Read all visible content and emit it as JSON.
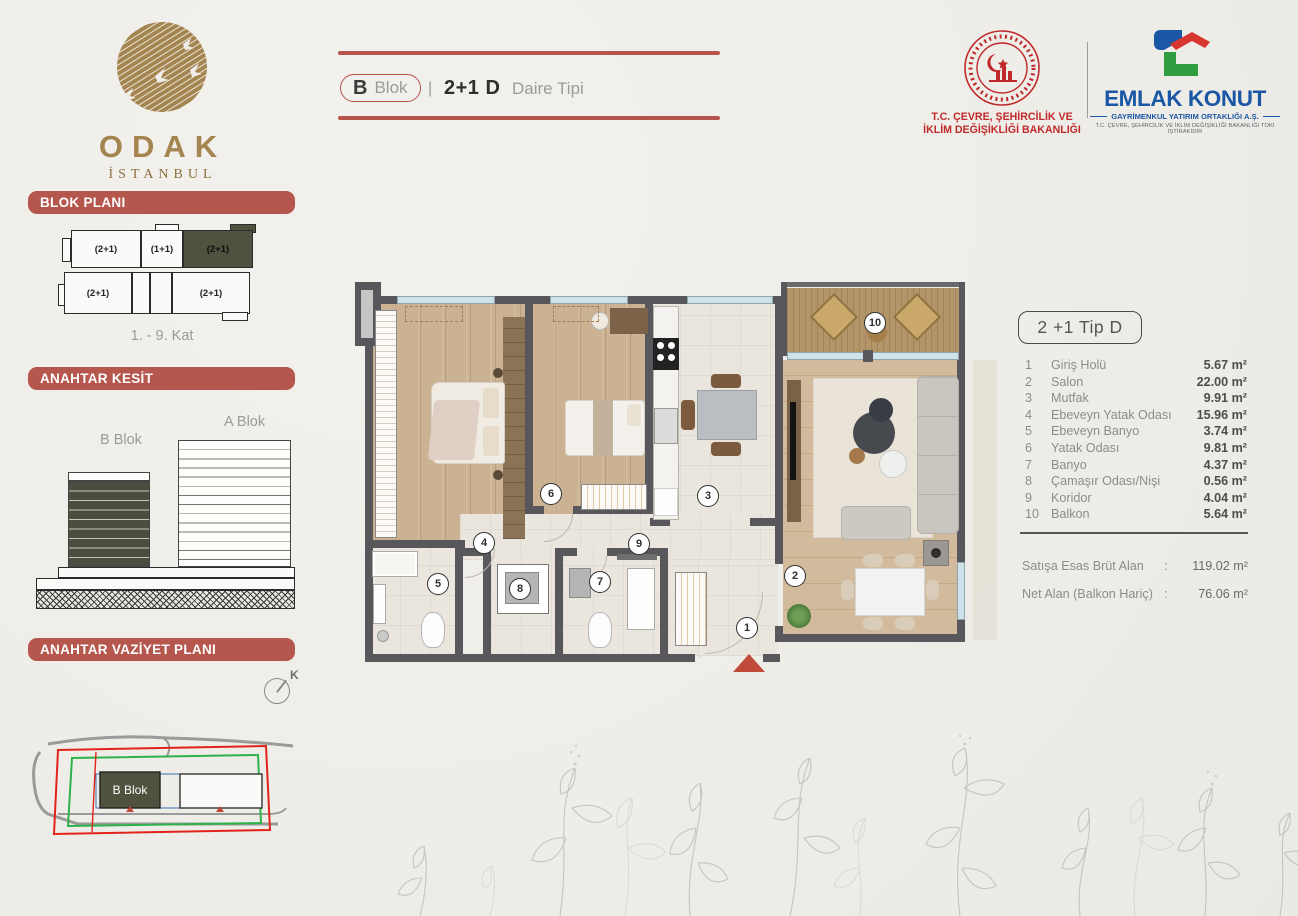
{
  "header": {
    "block_letter": "B",
    "block_word": "Blok",
    "separator": "|",
    "unit_type": "2+1 D",
    "subtitle": "Daire Tipi"
  },
  "brand": {
    "name": "ODAK",
    "city": "İSTANBUL"
  },
  "ministry": {
    "line1": "T.C. ÇEVRE, ŞEHİRCİLİK VE",
    "line2": "İKLİM DEĞİŞİKLİĞİ BAKANLIĞI"
  },
  "emlak": {
    "name": "EMLAK KONUT",
    "subtitle": "GAYRİMENKUL YATIRIM ORTAKLIĞI A.Ş.",
    "tagline": "T.C. ÇEVRE, ŞEHİRCİLİK VE İKLİM DEĞİŞİKLİĞİ BAKANLIĞI TOKİ İŞTİRAKİDİR"
  },
  "sidebar": {
    "section1_title": "BLOK PLANI",
    "section2_title": "ANAHTAR KESİT",
    "section3_title": "ANAHTAR VAZİYET PLANI",
    "block_plan": {
      "units": [
        "(2+1)",
        "(1+1)",
        "(2+1)",
        "(2+1)",
        "(2+1)"
      ],
      "caption": "1. - 9. Kat"
    },
    "kesit": {
      "a_label": "A Blok",
      "b_label": "B Blok"
    },
    "vaziyet": {
      "b_label": "B Blok",
      "compass": "K"
    }
  },
  "unit_card": {
    "title": "2 +1 Tip D",
    "rooms": [
      {
        "no": "1",
        "name": "Giriş Holü",
        "area": "5.67 m²"
      },
      {
        "no": "2",
        "name": "Salon",
        "area": "22.00 m²"
      },
      {
        "no": "3",
        "name": "Mutfak",
        "area": "9.91 m²"
      },
      {
        "no": "4",
        "name": "Ebeveyn Yatak Odası",
        "area": "15.96 m²"
      },
      {
        "no": "5",
        "name": "Ebeveyn Banyo",
        "area": "3.74 m²"
      },
      {
        "no": "6",
        "name": "Yatak Odası",
        "area": "9.81 m²"
      },
      {
        "no": "7",
        "name": "Banyo",
        "area": "4.37 m²"
      },
      {
        "no": "8",
        "name": "Çamaşır Odası/Nişi",
        "area": "0.56 m²"
      },
      {
        "no": "9",
        "name": "Koridor",
        "area": "4.04 m²"
      },
      {
        "no": "10",
        "name": "Balkon",
        "area": "5.64 m²"
      }
    ],
    "summary": [
      {
        "label": "Satışa Esas Brüt Alan",
        "colon": ":",
        "value": "119.02 m²"
      },
      {
        "label": "Net Alan (Balkon Hariç)",
        "colon": ":",
        "value": "76.06 m²"
      }
    ]
  },
  "plan": {
    "markers": [
      "1",
      "2",
      "3",
      "4",
      "5",
      "6",
      "7",
      "8",
      "9",
      "10"
    ]
  },
  "colors": {
    "accent_red": "#b5574c",
    "brand_gold": "#a5854f",
    "emlak_blue": "#1a57a4",
    "ministry_red": "#c0292b",
    "wall_gray": "#58575b",
    "highlight_dark": "#50513f"
  }
}
